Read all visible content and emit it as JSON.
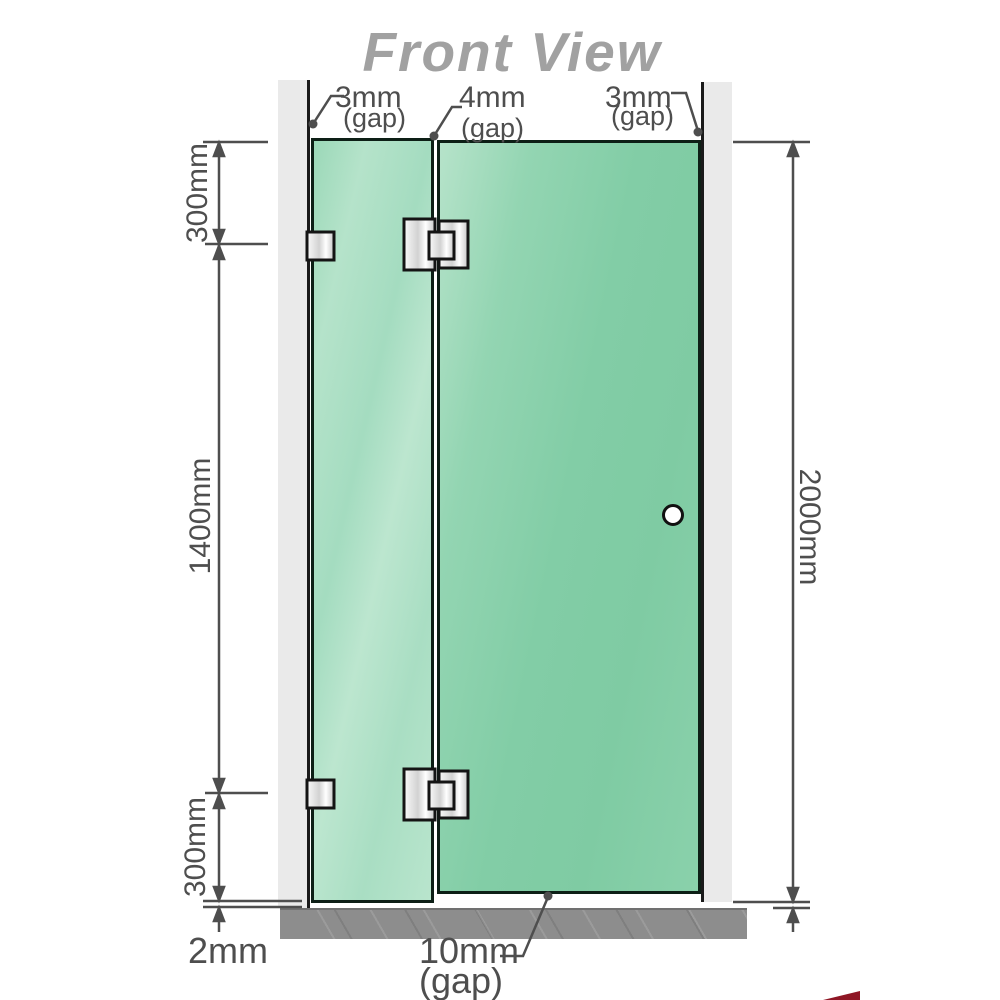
{
  "title": "Front View",
  "gaps": {
    "top_left": {
      "value": "3mm",
      "label": "(gap)"
    },
    "top_middle": {
      "value": "4mm",
      "label": "(gap)"
    },
    "top_right": {
      "value": "3mm",
      "label": "(gap)"
    },
    "bottom": {
      "value": "10mm",
      "label": "(gap)"
    }
  },
  "dimensions": {
    "upper_left": "300mm",
    "middle_left": "1400mm",
    "lower_left": "300mm",
    "floor_gap": "2mm",
    "total_height": "2000mm"
  },
  "colors": {
    "title_gray": "#a1a1a1",
    "glass_fixed": "#aadec3",
    "glass_door": "#82cda6",
    "wall_channel": "#eaeaea",
    "floor_gray": "#8d8d8d",
    "annotation_gray": "#4e4e4e",
    "watermark_red": "#8f1725"
  }
}
